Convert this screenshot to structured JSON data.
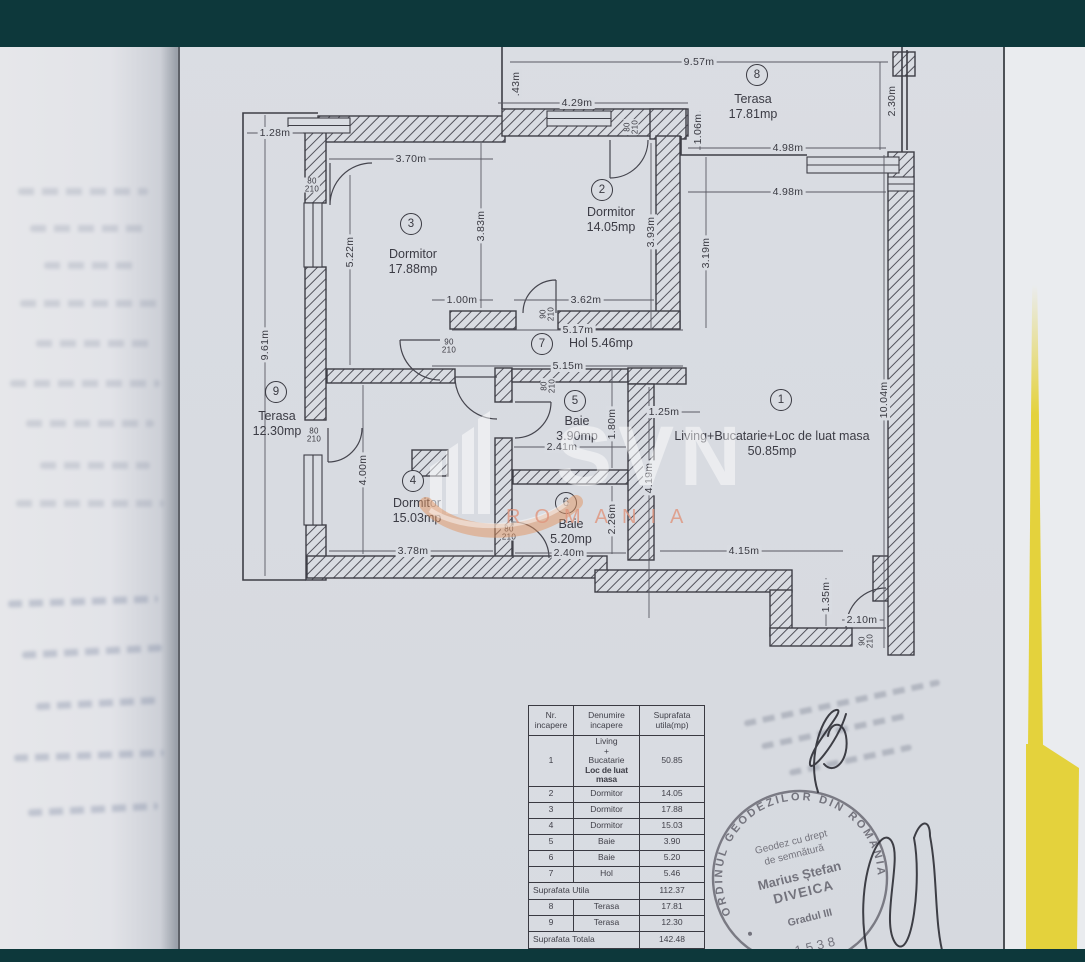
{
  "colors": {
    "teal_bar": "#0d383b",
    "paper": "#d9dce2",
    "folder_yellow": "#e4d23c",
    "watermark_orange": "#de9270"
  },
  "watermark": {
    "logo": "SVN",
    "country": "ROMANIA"
  },
  "floorplan": {
    "rooms": [
      {
        "num": "1",
        "cx": 781,
        "cy": 400,
        "name": "Living+Bucatarie+Loc de luat masa",
        "area": "50.85mp",
        "lx": 772,
        "ly": 429,
        "w": 250
      },
      {
        "num": "2",
        "cx": 602,
        "cy": 190,
        "name": "Dormitor",
        "area": "14.05mp",
        "lx": 611,
        "ly": 205,
        "w": 90
      },
      {
        "num": "3",
        "cx": 411,
        "cy": 224,
        "name": "Dormitor",
        "area": "17.88mp",
        "lx": 413,
        "ly": 247,
        "w": 90
      },
      {
        "num": "4",
        "cx": 413,
        "cy": 481,
        "name": "Dormitor",
        "area": "15.03mp",
        "lx": 417,
        "ly": 496,
        "w": 100
      },
      {
        "num": "5",
        "cx": 575,
        "cy": 401,
        "name": "Baie",
        "area": "3.90mp",
        "lx": 577,
        "ly": 414,
        "w": 70
      },
      {
        "num": "6",
        "cx": 566,
        "cy": 503,
        "name": "Baie",
        "area": "5.20mp",
        "lx": 571,
        "ly": 517,
        "w": 70
      },
      {
        "num": "7",
        "cx": 542,
        "cy": 344,
        "name": "Hol 5.46mp",
        "area": "",
        "lx": 601,
        "ly": 336,
        "w": 110
      },
      {
        "num": "8",
        "cx": 757,
        "cy": 75,
        "name": "Terasa",
        "area": "17.81mp",
        "lx": 753,
        "ly": 92,
        "w": 90
      },
      {
        "num": "9",
        "cx": 276,
        "cy": 392,
        "name": "Terasa",
        "area": "12.30mp",
        "lx": 277,
        "ly": 409,
        "w": 90
      }
    ],
    "dimension_labels": [
      {
        "t": "9.57m",
        "x": 699,
        "y": 62,
        "r": 0
      },
      {
        "t": ".43m",
        "x": 516,
        "y": 84,
        "r": -90
      },
      {
        "t": "4.29m",
        "x": 577,
        "y": 103,
        "r": 0
      },
      {
        "t": "1.28m",
        "x": 275,
        "y": 133,
        "r": 0
      },
      {
        "t": "3.70m",
        "x": 411,
        "y": 159,
        "r": 0
      },
      {
        "t": "4.98m",
        "x": 788,
        "y": 148,
        "r": 0
      },
      {
        "t": "4.98m",
        "x": 788,
        "y": 192,
        "r": 0
      },
      {
        "t": "2.30m",
        "x": 892,
        "y": 101,
        "r": -90
      },
      {
        "t": "1.06m",
        "x": 698,
        "y": 129,
        "r": -90
      },
      {
        "t": "3.83m",
        "x": 481,
        "y": 226,
        "r": -90
      },
      {
        "t": "5.22m",
        "x": 350,
        "y": 252,
        "r": -90
      },
      {
        "t": "3.93m",
        "x": 651,
        "y": 232,
        "r": -90
      },
      {
        "t": "3.19m",
        "x": 706,
        "y": 253,
        "r": -90
      },
      {
        "t": "9.61m",
        "x": 265,
        "y": 345,
        "r": -90
      },
      {
        "t": "1.00m",
        "x": 462,
        "y": 300,
        "r": 0
      },
      {
        "t": "3.62m",
        "x": 586,
        "y": 300,
        "r": 0
      },
      {
        "t": "5.17m",
        "x": 578,
        "y": 330,
        "r": 0
      },
      {
        "t": "5.15m",
        "x": 568,
        "y": 366,
        "r": 0
      },
      {
        "t": "1.25m",
        "x": 664,
        "y": 412,
        "r": 0
      },
      {
        "t": "1.80m",
        "x": 612,
        "y": 424,
        "r": -90
      },
      {
        "t": "2.41m",
        "x": 562,
        "y": 447,
        "r": 0
      },
      {
        "t": "10.04m",
        "x": 884,
        "y": 400,
        "r": -90
      },
      {
        "t": "4.19m",
        "x": 649,
        "y": 478,
        "r": -90
      },
      {
        "t": "2.26m",
        "x": 612,
        "y": 519,
        "r": -90
      },
      {
        "t": "4.00m",
        "x": 363,
        "y": 470,
        "r": -90
      },
      {
        "t": "3.78m",
        "x": 413,
        "y": 551,
        "r": 0
      },
      {
        "t": "2.40m",
        "x": 569,
        "y": 553,
        "r": 0
      },
      {
        "t": "4.15m",
        "x": 744,
        "y": 551,
        "r": 0
      },
      {
        "t": "1.35m",
        "x": 826,
        "y": 597,
        "r": -90
      },
      {
        "t": "2.10m",
        "x": 862,
        "y": 620,
        "r": 0
      }
    ],
    "door_labels": [
      {
        "t": "80/210",
        "x": 312,
        "y": 185,
        "r": 0
      },
      {
        "t": "80/210",
        "x": 631,
        "y": 127,
        "r": -90
      },
      {
        "t": "90/210",
        "x": 449,
        "y": 346,
        "r": 0
      },
      {
        "t": "90/210",
        "x": 547,
        "y": 314,
        "r": -90
      },
      {
        "t": "80/210",
        "x": 548,
        "y": 386,
        "r": -90
      },
      {
        "t": "80/210",
        "x": 314,
        "y": 435,
        "r": 0
      },
      {
        "t": "80/210",
        "x": 509,
        "y": 533,
        "r": 0
      },
      {
        "t": "90/210",
        "x": 866,
        "y": 641,
        "r": -90
      }
    ]
  },
  "table": {
    "headers": [
      "Nr. incapere",
      "Denumire incapere",
      "Suprafata utila(mp)"
    ],
    "rows": [
      {
        "nr": "1",
        "name_lines": [
          "Living",
          "+",
          "Bucatarie",
          "Loc de luat masa"
        ],
        "area": "50.85"
      },
      {
        "nr": "2",
        "name_lines": [
          "Dormitor"
        ],
        "area": "14.05"
      },
      {
        "nr": "3",
        "name_lines": [
          "Dormitor"
        ],
        "area": "17.88"
      },
      {
        "nr": "4",
        "name_lines": [
          "Dormitor"
        ],
        "area": "15.03"
      },
      {
        "nr": "5",
        "name_lines": [
          "Baie"
        ],
        "area": "3.90"
      },
      {
        "nr": "6",
        "name_lines": [
          "Baie"
        ],
        "area": "5.20"
      },
      {
        "nr": "7",
        "name_lines": [
          "Hol"
        ],
        "area": "5.46"
      }
    ],
    "subtotal_label": "Suprafata Utila",
    "subtotal_value": "112.37",
    "terrace_rows": [
      {
        "nr": "8",
        "name_lines": [
          "Terasa"
        ],
        "area": "17.81"
      },
      {
        "nr": "9",
        "name_lines": [
          "Terasa"
        ],
        "area": "12.30"
      }
    ],
    "total_label": "Suprafata Totala",
    "total_value": "142.48"
  },
  "stamp": {
    "ring_text": "ORDINUL GEODEZILOR DIN ROMÂNIA",
    "line1": "Geodez cu drept",
    "line2": "de semnătură",
    "name1": "Marius Ștefan",
    "name2": "DIVEICA",
    "grade": "Gradul III",
    "number": "1538"
  }
}
